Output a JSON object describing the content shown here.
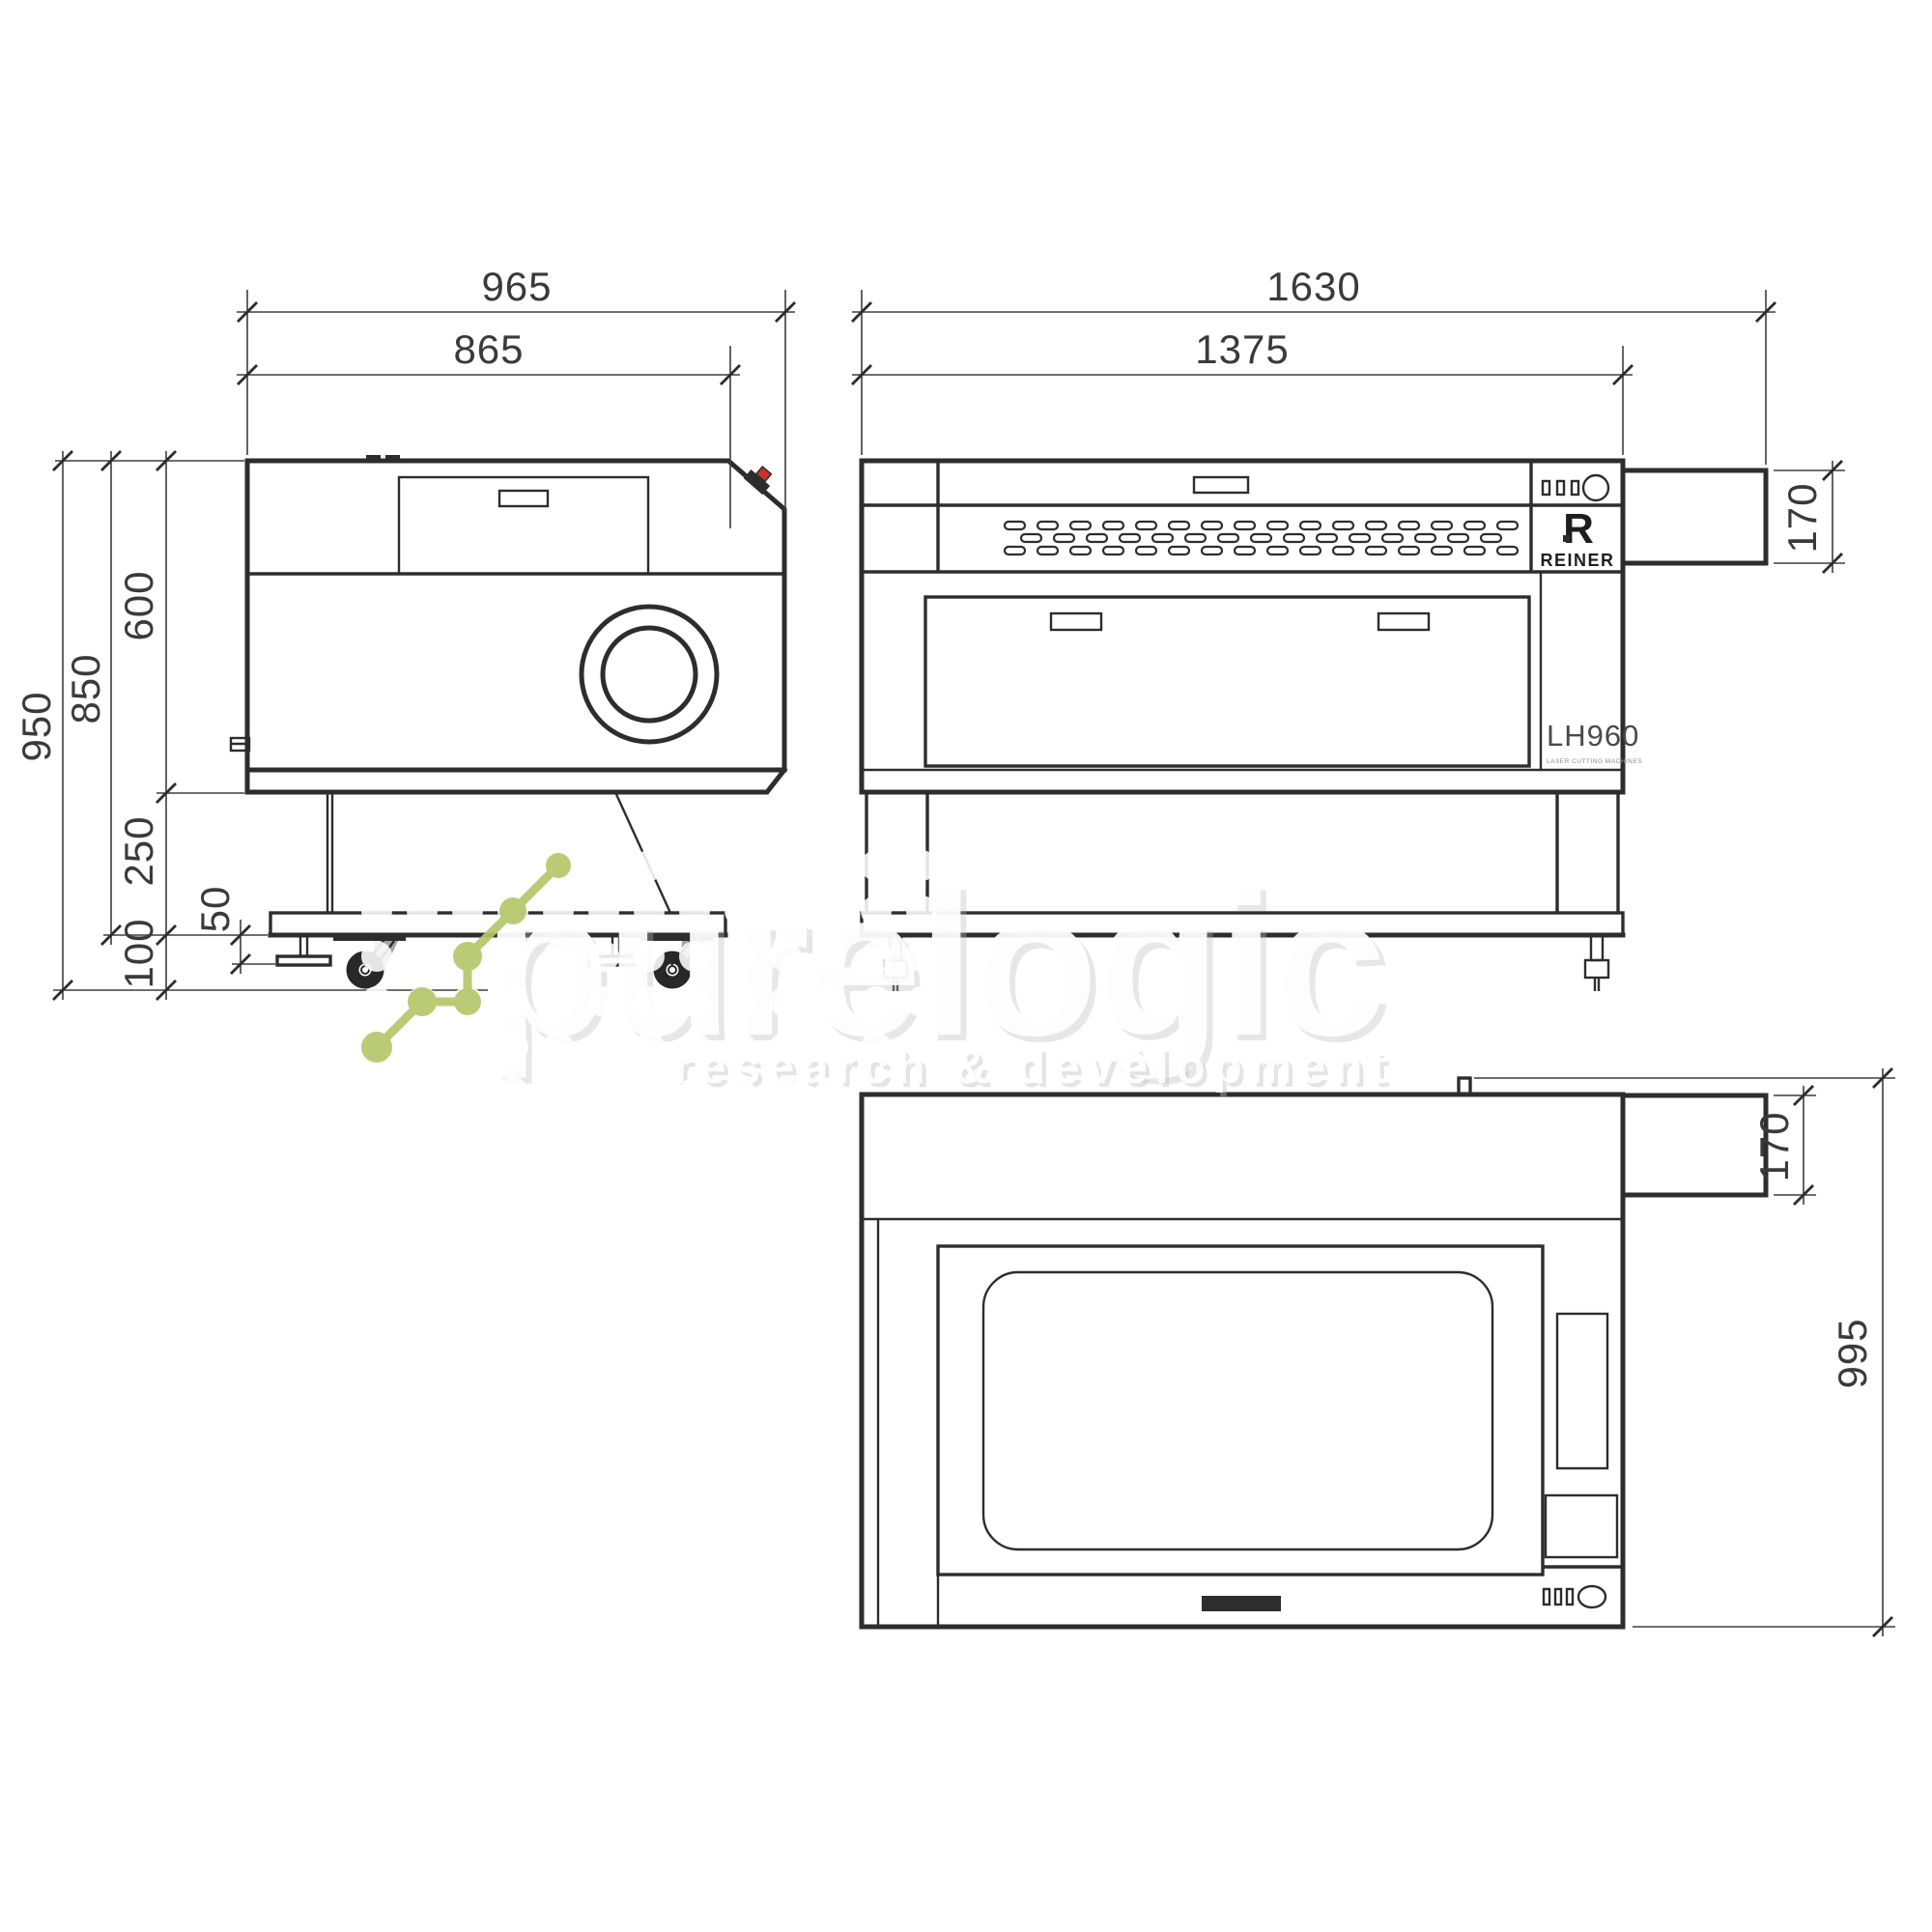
{
  "drawing": {
    "side_view": {
      "dims": {
        "width_total": "965",
        "width_body": "865",
        "height_total": "950",
        "height_upper": "850",
        "height_body": "600",
        "height_stand": "250",
        "height_feet": "50",
        "height_clearance": "100"
      }
    },
    "front_view": {
      "dims": {
        "width_total": "1630",
        "width_body": "1375",
        "exhaust_height": "170"
      }
    },
    "top_view": {
      "dims": {
        "depth_total": "995",
        "exhaust_width": "170"
      }
    },
    "branding": {
      "logo_letter": "R",
      "logo_name": "REINER",
      "model": "LH960",
      "model_subtitle": "LASER CUTTING MACHINES"
    },
    "watermark": {
      "title": "purelogic",
      "subtitle": "research & development"
    },
    "colors": {
      "line": "#2d2d2d",
      "dimension": "#3e3e3e",
      "watermark_green": "#b5c76b",
      "estop_red": "#c8322b"
    }
  }
}
